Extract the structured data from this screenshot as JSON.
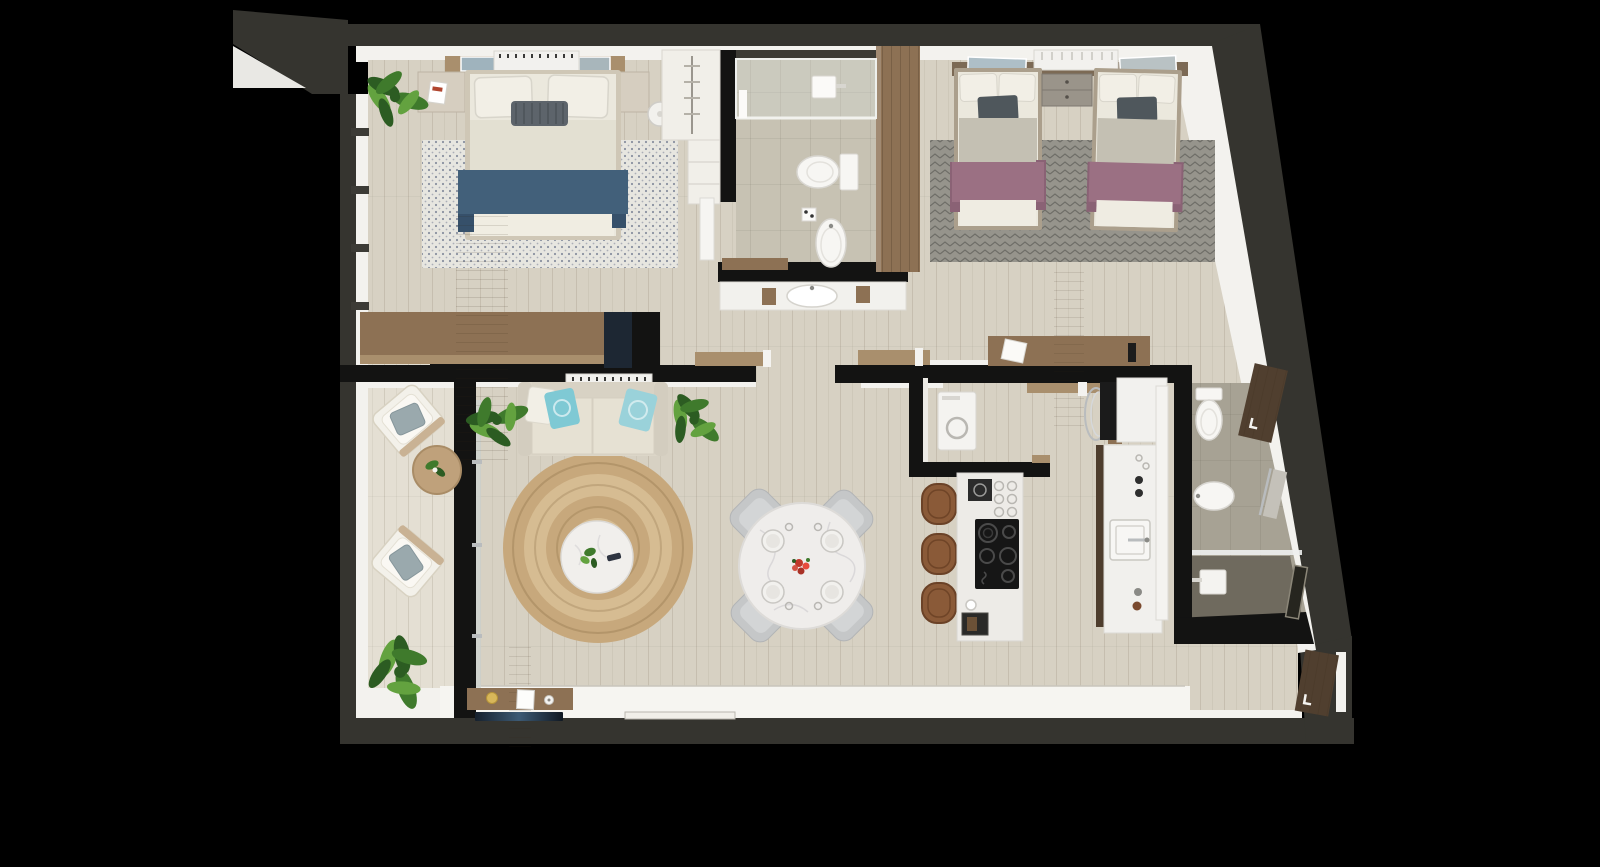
{
  "scene": {
    "kind": "3d-rendered-floor-plan",
    "view": "top-down",
    "background": "#000000"
  },
  "rooms": [
    {
      "name": "master-bedroom",
      "items": [
        "double-bed",
        "blue-throw-blanket",
        "patterned-rug",
        "nightstand-left",
        "nightstand-right",
        "floor-lamp",
        "headboard-console",
        "wall-art",
        "ac-unit",
        "potted-plant",
        "dresser-credenza",
        "tv-panel",
        "built-in-closet",
        "window-wall"
      ]
    },
    {
      "name": "bathroom-1",
      "items": [
        "walk-in-shower",
        "shower-head",
        "toilet",
        "pedestal-sink",
        "vanity-basin",
        "wood-wardrobe-panel",
        "wood-bench"
      ]
    },
    {
      "name": "bedroom-2",
      "items": [
        "twin-bed-left",
        "twin-bed-right",
        "shared-nightstand",
        "mauve-throw-blankets",
        "chevron-rug",
        "headboard-shelf",
        "wall-art",
        "radiator-panel",
        "wood-sideboard",
        "open-door"
      ]
    },
    {
      "name": "living-room",
      "items": [
        "sofa",
        "teal-accent-pillows",
        "potted-plant-left",
        "potted-plant-right",
        "ac-unit",
        "round-jute-rug",
        "round-marble-coffee-table",
        "tv-console",
        "flat-tv-panel",
        "terrace-strip"
      ]
    },
    {
      "name": "dining-area",
      "items": [
        "round-marble-table",
        "upholstered-chair-x4",
        "place-setting-x4",
        "red-flower-centerpiece"
      ]
    },
    {
      "name": "kitchen",
      "items": [
        "island-with-cooktop",
        "bar-stool-x3",
        "coffee-machine",
        "glassware",
        "island-sink",
        "counter-with-square-sink",
        "tall-fridge-cabinet",
        "faucet",
        "control-knobs"
      ]
    },
    {
      "name": "laundry-closet",
      "items": [
        "washing-machine",
        "chrome-drying-rack",
        "wood-shelf"
      ]
    },
    {
      "name": "bathroom-2",
      "items": [
        "toilet",
        "bidet",
        "walk-in-shower",
        "shower-head",
        "shower-glass",
        "towel-rail",
        "wood-cabinet",
        "wood-bench",
        "open-door"
      ]
    },
    {
      "name": "balcony",
      "items": [
        "lounge-chair-top",
        "lounge-chair-bottom",
        "round-side-table",
        "small-plant",
        "large-plant",
        "sliding-glass-door"
      ]
    },
    {
      "name": "hallway",
      "items": [
        "open-door-master",
        "open-door-bedroom-2",
        "open-door-utility"
      ]
    }
  ],
  "colors": {
    "wall_outer": "#35342f",
    "wall_inner": "#131312",
    "trim": "#f3f2ee",
    "floor": "#d7d1c3",
    "floor_balcony": "#e4dfd3",
    "terrace": "#f6f5f1",
    "tile_bath1": "#c7c2b3",
    "tile_bath2": "#a7a294",
    "shower_floor": "#6f6a5e",
    "wood": "#8d7154",
    "wood_light": "#a98f6d",
    "wood_dark": "#503f2f",
    "wood_gray": "#ab9f8c",
    "rug_master": "#e7e6e0",
    "rug_master_dot": "#4a5470",
    "rug_twin": "#96948c",
    "rug_twin_dark": "#716e66",
    "jute_outer": "#c7a87c",
    "jute_inner": "#d6bc92",
    "sofa": "#dcd6c8",
    "sofa_seat": "#e6e1d3",
    "pillow_white": "#f2efe6",
    "teal": "#7fc9d4",
    "teal_light": "#9ad2da",
    "pillow_gray": "#5d646b",
    "throw_blue": "#42607a",
    "throw_mauve": "#9b7083",
    "mauve_dark": "#8a6275",
    "blanket": "#c4c0b3",
    "mattress": "#ebe8dd",
    "marble": "#efedeb",
    "chair_gray": "#c5c7c8",
    "stool": "#8a5a38",
    "stool_dark": "#6b4227",
    "cooktop": "#161616",
    "appliance_white": "#f2f1ee",
    "chrome": "#b9bcbe",
    "plant": "#3f7a2c",
    "plant_light": "#63a23f",
    "plant_dark": "#2c5c22",
    "tv_dark": "#1d2733"
  }
}
